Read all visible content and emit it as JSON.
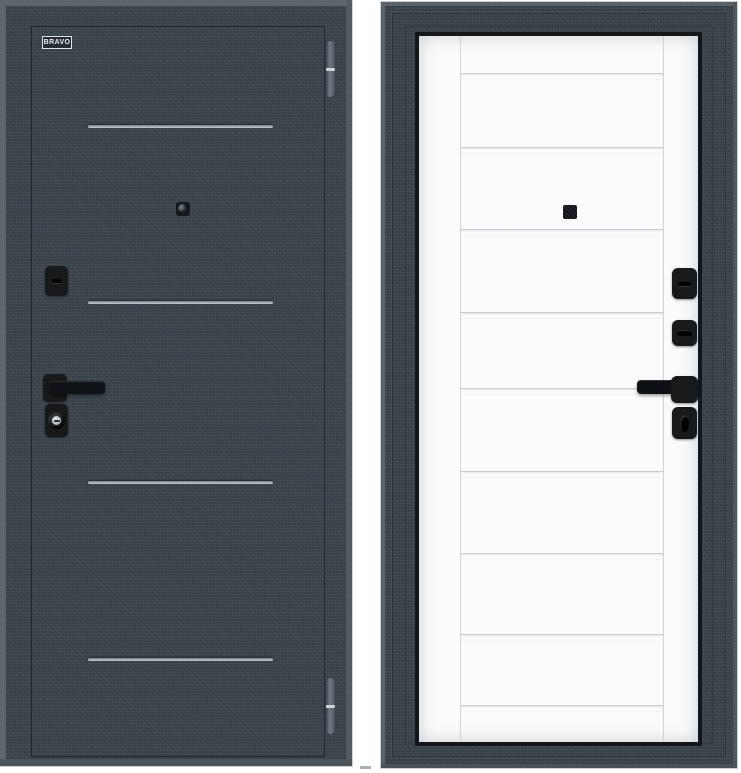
{
  "scene": {
    "background_color": "#ffffff",
    "caption": "Steel entry door product photo: dark exterior panel and white interior panel"
  },
  "left_door": {
    "brand_badge": "BRAVO",
    "slab_color": "#3a434b",
    "edge_highlight_color": "#5e666d",
    "groove_color": "#c6cdd1",
    "hardware_color": "#17191b",
    "groove_count": 4,
    "hinge_count": 2,
    "hardware": [
      "peephole",
      "deadbolt-escutcheon",
      "lever-handle",
      "cylinder-escutcheon"
    ]
  },
  "right_door": {
    "casing_color": "#39424a",
    "trim_color": "#14171a",
    "leaf_color": "#fafbfb",
    "divider_color": "#c6cbce",
    "hardware_color": "#17191b",
    "glass_strip_count": 9,
    "hardware": [
      "peephole",
      "thumbturn-upper",
      "thumbturn-lower",
      "lever-handle",
      "cylinder-escutcheon"
    ]
  }
}
